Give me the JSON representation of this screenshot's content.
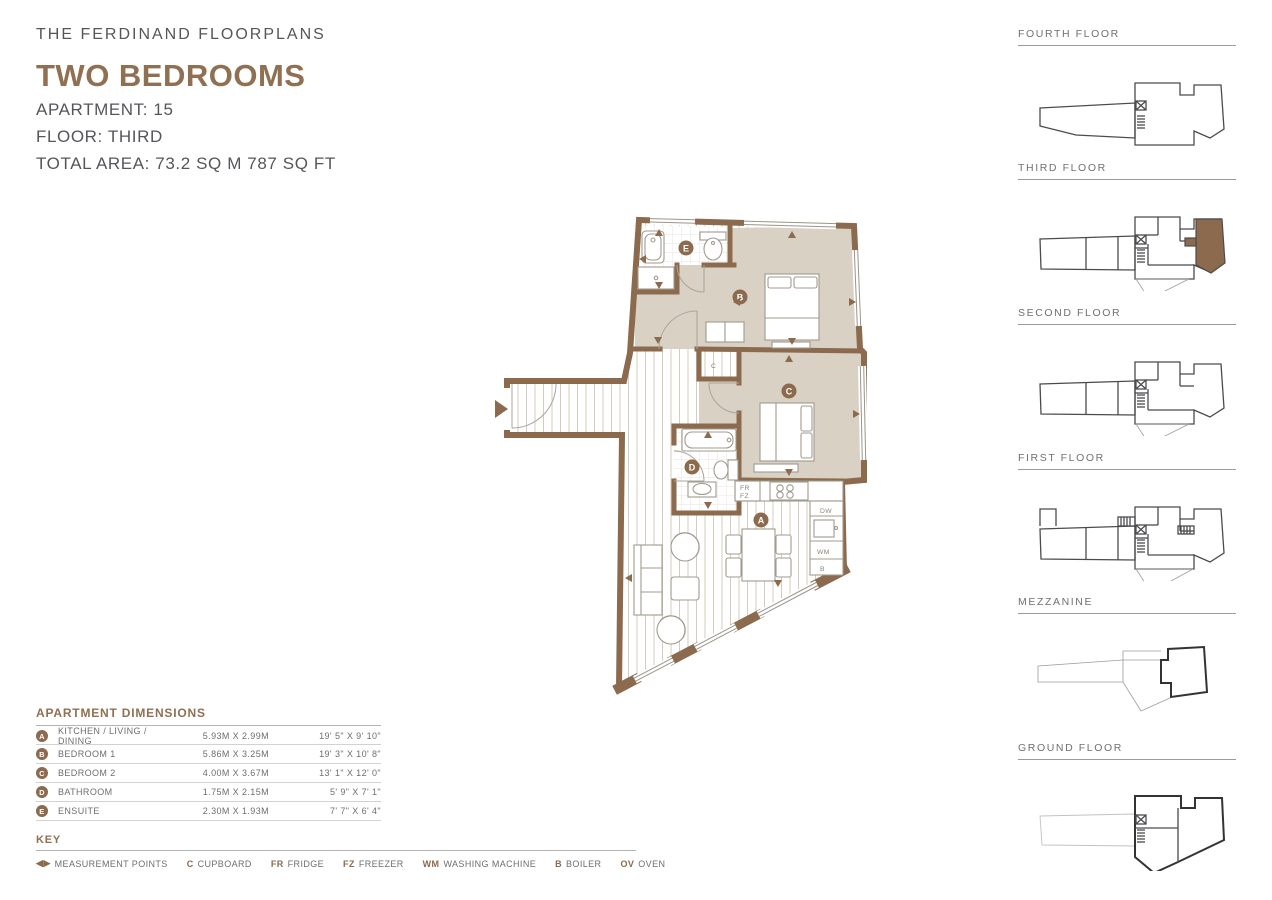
{
  "colors": {
    "accent": "#8f7052",
    "wall": "#8b6a4e",
    "floor_highlight": "#8b6b4d",
    "bedroom_floor": "#d9d1c4",
    "text_gray": "#57585a"
  },
  "header": {
    "subtitle": "THE FERDINAND FLOORPLANS",
    "title": "TWO BEDROOMS",
    "apartment": "APARTMENT: 15",
    "floor": "FLOOR: THIRD",
    "total_area": "TOTAL AREA: 73.2 SQ M   787 SQ FT"
  },
  "plan": {
    "room_labels": [
      {
        "letter": "A"
      },
      {
        "letter": "B"
      },
      {
        "letter": "C"
      },
      {
        "letter": "D"
      },
      {
        "letter": "E"
      }
    ],
    "appliances": [
      {
        "code": "FR"
      },
      {
        "code": "FZ"
      },
      {
        "code": "DW"
      },
      {
        "code": "WM"
      },
      {
        "code": "B"
      },
      {
        "code": "C"
      }
    ]
  },
  "floors": [
    {
      "label": "FOURTH FLOOR",
      "highlighted": false
    },
    {
      "label": "THIRD FLOOR",
      "highlighted": true
    },
    {
      "label": "SECOND FLOOR",
      "highlighted": false
    },
    {
      "label": "FIRST FLOOR",
      "highlighted": false
    },
    {
      "label": "MEZZANINE",
      "highlighted": false
    },
    {
      "label": "GROUND FLOOR",
      "highlighted": false
    }
  ],
  "dimensions": {
    "title": "APARTMENT DIMENSIONS",
    "rows": [
      {
        "letter": "A",
        "name": "KITCHEN / LIVING / DINING",
        "metric": "5.93M X 2.99M",
        "imperial": "19' 5\" X 9' 10\""
      },
      {
        "letter": "B",
        "name": "BEDROOM 1",
        "metric": "5.86M X 3.25M",
        "imperial": "19' 3\" X 10' 8\""
      },
      {
        "letter": "C",
        "name": "BEDROOM 2",
        "metric": "4.00M X 3.67M",
        "imperial": "13' 1\" X 12' 0\""
      },
      {
        "letter": "D",
        "name": "BATHROOM",
        "metric": "1.75M X 2.15M",
        "imperial": "5' 9\" X 7' 1\""
      },
      {
        "letter": "E",
        "name": "ENSUITE",
        "metric": "2.30M X 1.93M",
        "imperial": "7' 7\" X 6' 4\""
      }
    ]
  },
  "key": {
    "title": "KEY",
    "items": [
      {
        "symbol": "◀▶",
        "label": "MEASUREMENT POINTS"
      },
      {
        "symbol": "C",
        "label": "CUPBOARD"
      },
      {
        "symbol": "FR",
        "label": "FRIDGE"
      },
      {
        "symbol": "FZ",
        "label": "FREEZER"
      },
      {
        "symbol": "WM",
        "label": "WASHING MACHINE"
      },
      {
        "symbol": "B",
        "label": "BOILER"
      },
      {
        "symbol": "OV",
        "label": "OVEN"
      }
    ]
  }
}
